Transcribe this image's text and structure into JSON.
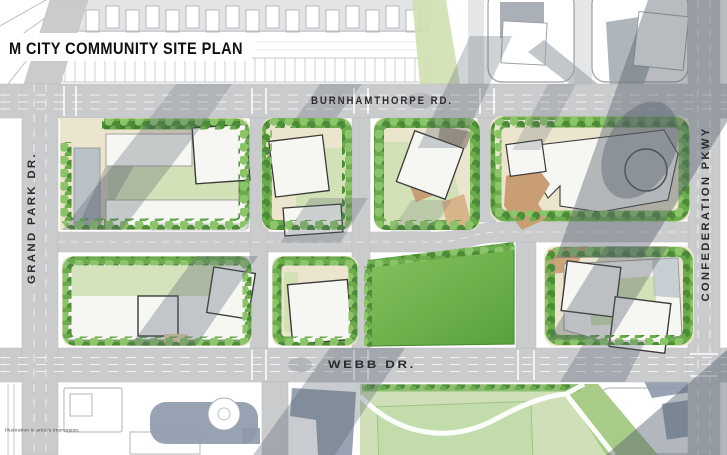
{
  "title": "M CITY COMMUNITY SITE PLAN",
  "disclaimer": "Illustration is artist's impression.",
  "roads": {
    "burnhamthorpe": "BURNHAMTHORPE RD.",
    "webb": "WEBB DR.",
    "grand_park": "GRAND PARK DR.",
    "confederation": "CONFEDERATION PKWY"
  },
  "palette": {
    "road": "#c9cbcd",
    "paving": "#ece5cd",
    "courtyard": "#d2e1b6",
    "park_green": "#6db14b",
    "south_park": "#cfe0b8",
    "tree_light": "#8cc46a",
    "tree_mid": "#6aab4c",
    "tree_dark": "#4c8c38",
    "hedge": "#3f7e30",
    "building": "#f6f6f3",
    "tower_outline": "#3a3a38",
    "plaza_tan": "#c99e74",
    "shadow": "#55606c",
    "context_line": "#b9bcc0",
    "context_blue": "#8e9aab",
    "title_color": "#111113",
    "label_color": "#2b2b2d"
  }
}
